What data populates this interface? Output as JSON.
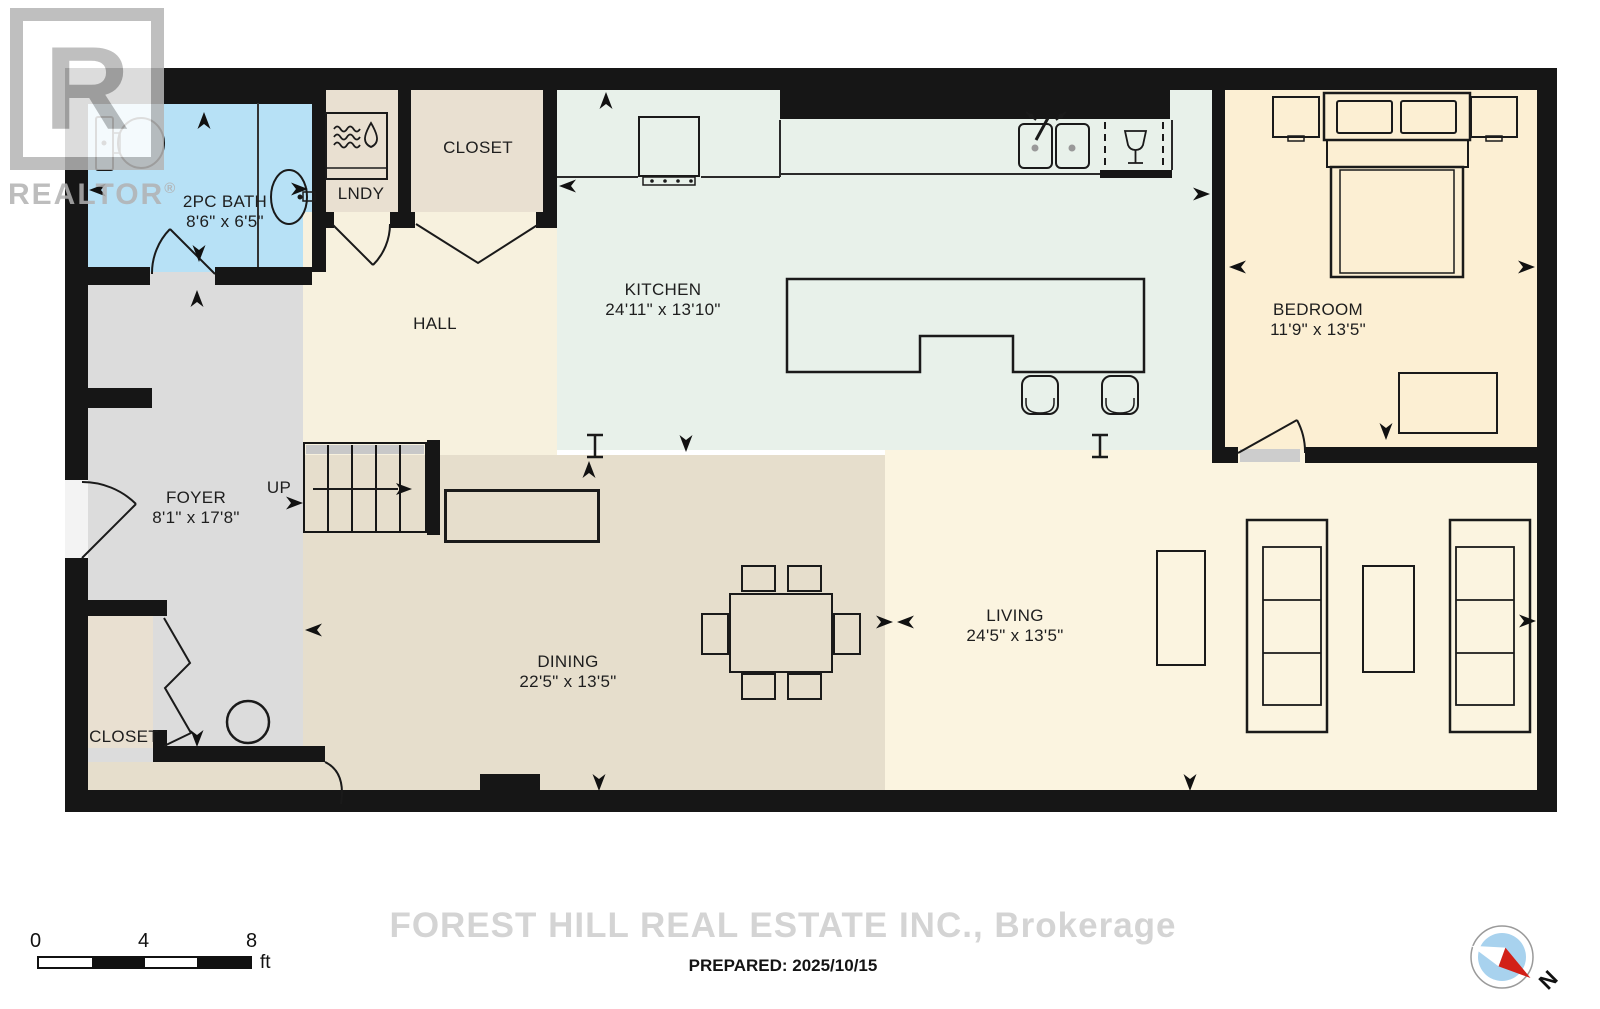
{
  "branding": {
    "logo_letter": "R",
    "logo_text": "REALTOR",
    "logo_trademark": "®",
    "brokerage_watermark": "FOREST HILL REAL ESTATE INC., Brokerage",
    "prepared": "PREPARED: 2025/10/15"
  },
  "scale_bar": {
    "tick_0": "0",
    "tick_4": "4",
    "tick_8": "8",
    "unit": "ft"
  },
  "compass": {
    "north_label": "N"
  },
  "stairs": {
    "direction_label": "UP"
  },
  "rooms": [
    {
      "name": "2PC BATH",
      "dims": "8'6\" x 6'5\""
    },
    {
      "name": "LNDY",
      "dims": ""
    },
    {
      "name": "CLOSET",
      "dims": ""
    },
    {
      "name": "HALL",
      "dims": ""
    },
    {
      "name": "KITCHEN",
      "dims": "24'11\" x 13'10\""
    },
    {
      "name": "BEDROOM",
      "dims": "11'9\" x 13'5\""
    },
    {
      "name": "FOYER",
      "dims": "8'1\" x 17'8\""
    },
    {
      "name": "DINING",
      "dims": "22'5\" x 13'5\""
    },
    {
      "name": "LIVING",
      "dims": "24'5\" x 13'5\""
    },
    {
      "name": "CLOSET",
      "dims": ""
    }
  ],
  "colors": {
    "wall": "#161616",
    "bath": "#b7e1f6",
    "closet_tan": "#e9e0d1",
    "hall": "#f7f1de",
    "kitchen": "#e8f1ea",
    "bedroom": "#fcefd3",
    "foyer": "#dcdcdc",
    "dining": "#e6decc",
    "living": "#fbf4e0",
    "compass_blue": "#a8d2ee",
    "compass_red": "#d22018"
  }
}
